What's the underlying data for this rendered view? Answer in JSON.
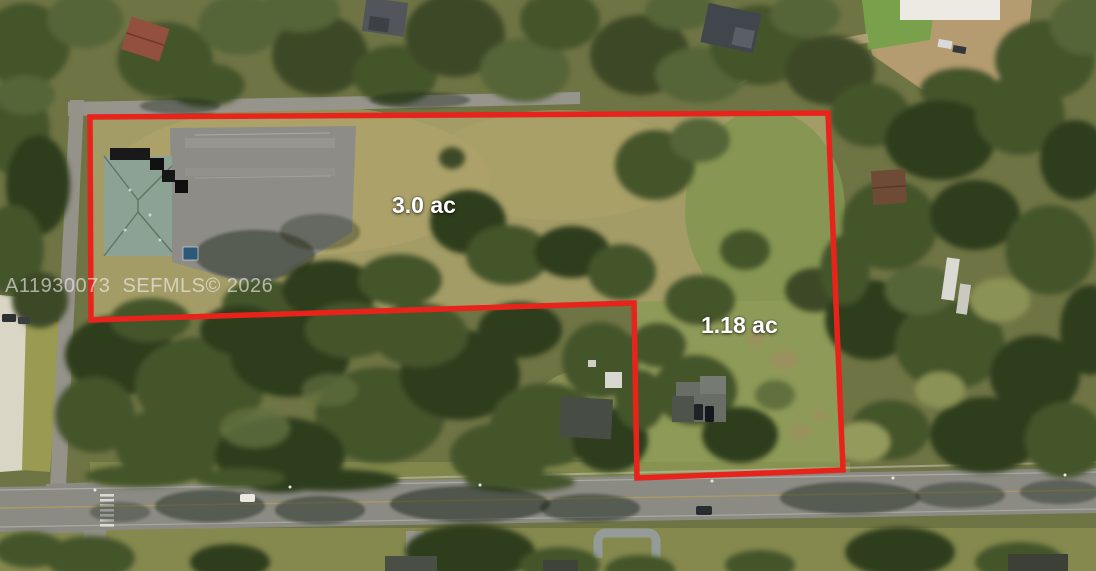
{
  "page": {
    "type": "real-estate-aerial-listing-photo"
  },
  "watermark": {
    "text": "A11930073  SEFMLS© 2026"
  },
  "parcels": [
    {
      "label": "3.0 ac",
      "area_acres": 3.0
    },
    {
      "label": "1.18 ac",
      "area_acres": 1.18
    }
  ],
  "boundary": {
    "color": "#e8231b"
  },
  "palette": {
    "field_tan": "#a49c66",
    "grass_green": "#8e9a57",
    "tree_green": "#3a4824",
    "road_gray": "#8b8a83",
    "building_roof_teal": "#8ca295",
    "label_text": "#ffffff"
  }
}
